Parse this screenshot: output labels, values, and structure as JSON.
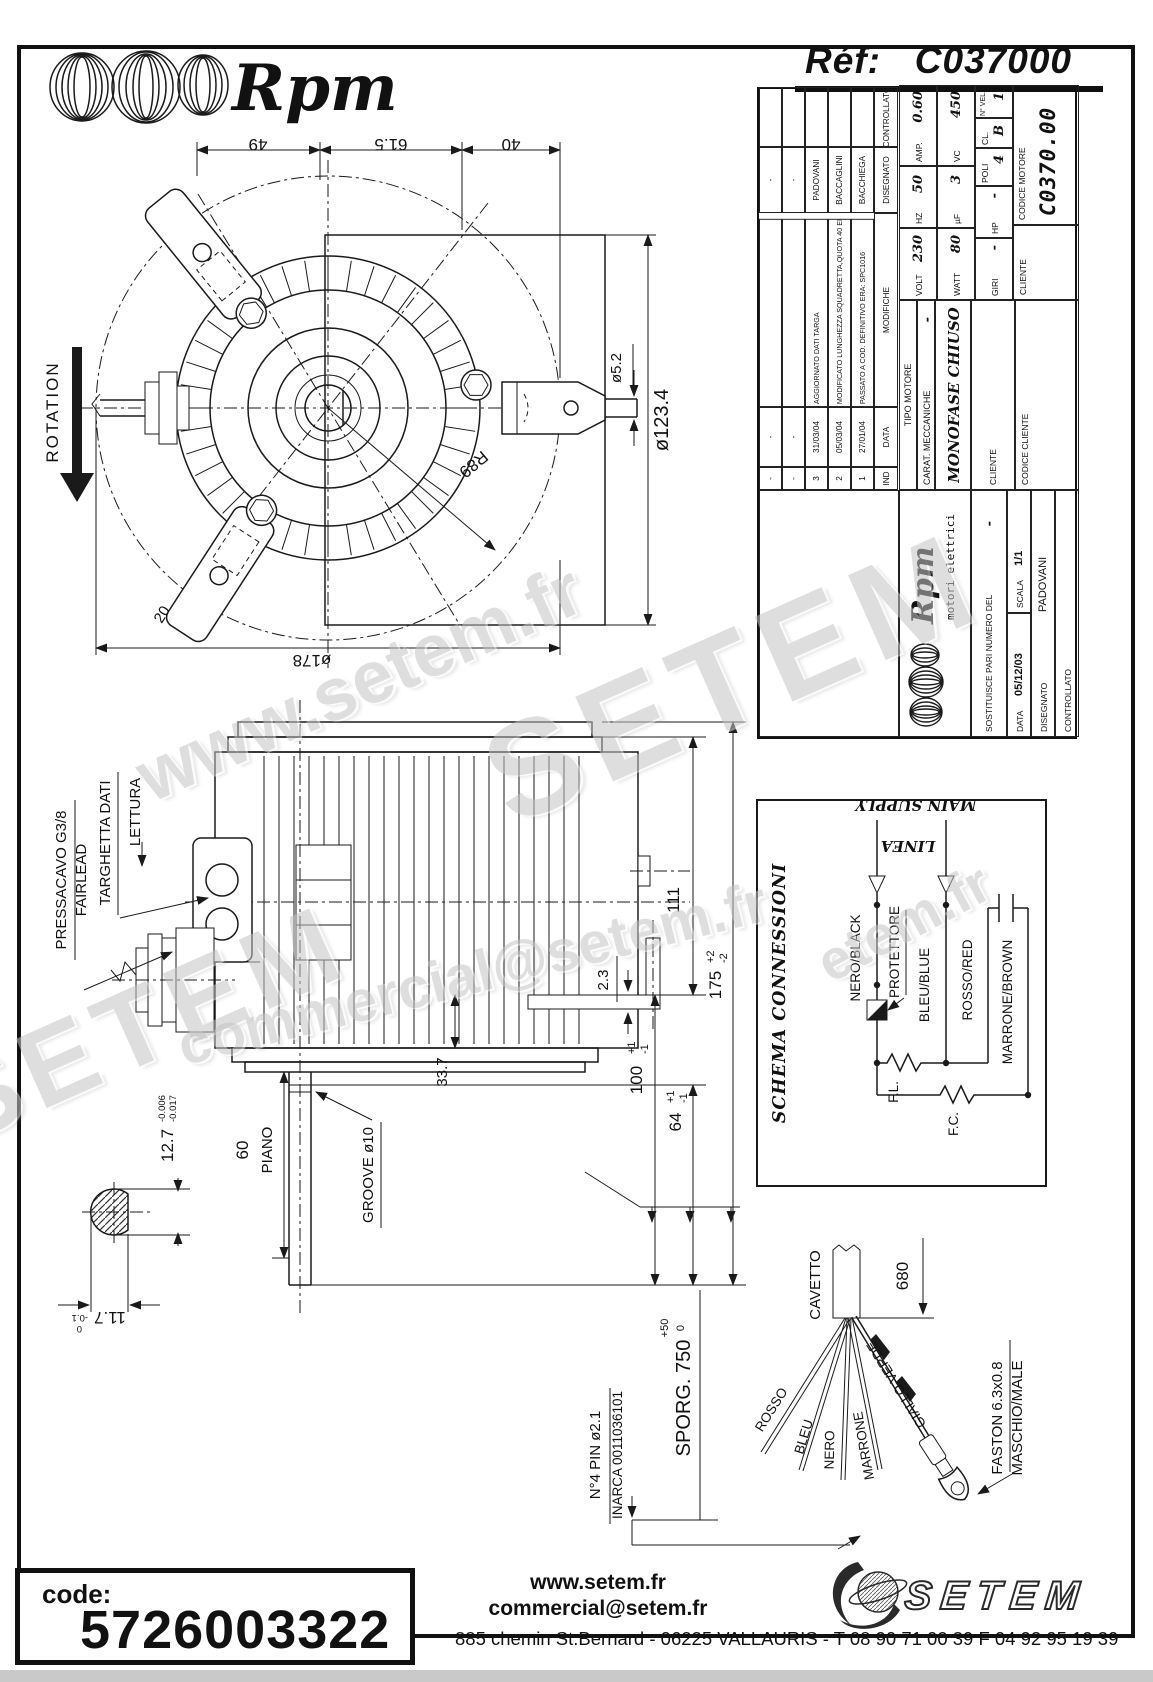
{
  "header": {
    "brand": "Rpm",
    "ref_label": "Réf:",
    "ref_value": "C037000"
  },
  "title_block": {
    "revisions": {
      "headers": [
        "IND",
        "DATA",
        "MODIFICHE",
        "DISEGNATO",
        "CONTROLLATO"
      ],
      "rows": [
        {
          "ind": "-",
          "data": "-",
          "modifiche": "",
          "disegnato": "-",
          "controllato": ""
        },
        {
          "ind": "-",
          "data": "-",
          "modifiche": "",
          "disegnato": "-",
          "controllato": ""
        },
        {
          "ind": "3",
          "data": "31/03/04",
          "modifiche": "AGGIORNATO DATI TARGA",
          "disegnato": "PADOVANI",
          "controllato": ""
        },
        {
          "ind": "2",
          "data": "05/03/04",
          "modifiche": "MODIFICATO LUNGHEZZA SQUADRETTA,QUOTA 40 ERA 35",
          "disegnato": "BACCAGLINI",
          "controllato": ""
        },
        {
          "ind": "1",
          "data": "27/01/04",
          "modifiche": "PASSATO A COD. DEFINITIVO ERA: SPC1016",
          "disegnato": "BACCHIEGA",
          "controllato": ""
        }
      ]
    },
    "motor": {
      "tipo_label": "TIPO MOTORE",
      "tipo": "MONOFASE CHIUSO",
      "carat_label": "CARAT. MECCANICHE",
      "carat": "-",
      "volt_label": "VOLT",
      "volt": "230",
      "hz_label": "HZ",
      "hz": "50",
      "amp_label": "AMP.",
      "amp": "0.60",
      "watt_label": "WATT",
      "watt": "80",
      "uf_label": "µF",
      "uf": "3",
      "vc_label": "VC",
      "vc": "450",
      "giri_label": "GIRI",
      "giri": "-",
      "hp_label": "HP",
      "hp": "-",
      "poli_label": "POLI",
      "poli": "4",
      "cl_label": "CL.",
      "cl": "B",
      "nvel_label": "N° VEL.",
      "nvel": "1"
    },
    "logo_name": "Rpm",
    "logo_sub": "motori elettrici",
    "sostituisce_label": "SOSTITUISCE PARI NUMERO DEL",
    "sostituisce": "-",
    "data_label": "DATA",
    "data": "05/12/03",
    "scala_label": "SCALA",
    "scala": "1/1",
    "disegnato_label": "DISEGNATO",
    "disegnato": "PADOVANI",
    "controllato_label": "CONTROLLATO",
    "controllato": "",
    "cliente_label": "CLIENTE",
    "cliente2_label": "CLIENTE",
    "codice_cliente_label": "CODICE CLIENTE",
    "codice_motore_label": "CODICE MOTORE",
    "codice_motore": "C0370.00"
  },
  "top_view": {
    "rotation": "ROTATION",
    "dim_49": "49",
    "dim_61_5": "61.5",
    "dim_40": "40",
    "dim_d52": "ø5.2",
    "dim_d1234": "ø123.4",
    "dim_r89": "R89",
    "dim_20": "20",
    "dim_d178": "ø178"
  },
  "side_view": {
    "pressacavo": "PRESSACAVO G3/8",
    "fairlead": "FAIRLEAD",
    "targhetta": "TARGHETTA DATI",
    "lettura": "LETTURA",
    "dim_111": "111",
    "dim_23": "2.3",
    "dim_337": "33.7",
    "dim_175": "175",
    "dim_175_tp": "+2",
    "dim_175_tm": "-2",
    "dim_100": "100",
    "dim_100_tp": "+1",
    "dim_100_tm": "-1",
    "dim_64": "64",
    "dim_64_tp": "+1",
    "dim_64_tm": "-1",
    "dim_60": "60",
    "piano": "PIANO",
    "groove": "GROOVE ø10",
    "dim_127": "12.7",
    "dim_127_ta": "-0.006",
    "dim_127_tb": "-0.017",
    "dim_117": "11.7",
    "dim_117_ta": "0",
    "dim_117_tb": "-0.1"
  },
  "schema": {
    "title": "SCHEMA CONNESSIONI",
    "main_supply": "MAIN SUPPLY",
    "linea": "LINEA",
    "nero": "NERO/BLACK",
    "protettore": "PROTETTORE",
    "bleu": "BLEU/BLUE",
    "rosso": "ROSSO/RED",
    "marrone": "MARRONE/BROWN",
    "fl": "F.L.",
    "fc": "F.C."
  },
  "cable": {
    "cavetto": "CAVETTO",
    "dim_680": "680",
    "sporg": "SPORG. 750",
    "sporg_tp": "+50",
    "sporg_tm": "0",
    "pin": "N°4 PIN ø2.1",
    "inarca": "INARCA 0011036101",
    "faston": "FASTON 6.3x0.8",
    "maschio": "MASCHIO/MALE",
    "rosso": "ROSSO",
    "bleu": "BLEU",
    "nero": "NERO",
    "marrone": "MARRONE",
    "giallo": "GIALLO-VERDE"
  },
  "footer": {
    "code_label": "code:",
    "code_value": "5726003322",
    "website": "www.setem.fr",
    "email": "commercial@setem.fr",
    "address": "885 chemin St.Bernard  -  06225 VALLAURIS  -  T 08 90 71 00 39   F 04 92 95 19 39",
    "setem": "SETEM"
  },
  "watermarks": [
    "www.setem.fr",
    "SETEM",
    "SETEM",
    "commercial@setem.fr",
    "etem.fr"
  ]
}
